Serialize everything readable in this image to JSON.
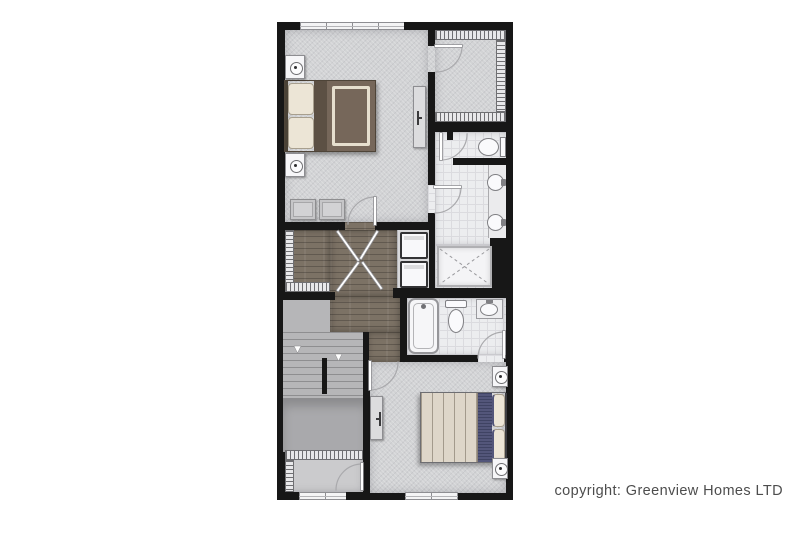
{
  "footer": {
    "copyright": "copyright: Greenview Homes LTD"
  },
  "colors": {
    "background": "#ffffff",
    "wall": "#171717",
    "carpet": "#d2d3d5",
    "tile": "#ecedef",
    "tile_line": "#dbdbdf",
    "wood": "#7c7265",
    "stair": "#b6b6b8",
    "stair_line": "#8e8e90",
    "landing": "#a9a9ac",
    "niche": "#d8d8da",
    "hatch_bg": "#e8e8ea",
    "hatch_line": "#6f6f72",
    "fixture_fill": "#f6f6f8",
    "fixture_line": "#8d8d91",
    "pillow": "#ece5d6",
    "pillow_line": "#a89f8e",
    "bed1_duvet": "#76675a",
    "bed1_fold": "#5c5044",
    "bed1_trim": "#e6dfce",
    "bed2_duvet": "#ded6c9",
    "bed2_line": "#a39a8c",
    "navy": "#53567a",
    "navy_dark": "#3f4363",
    "headboard": "#3e3e42",
    "door_arc": "#a9a9ac",
    "text": "#4d4d4d"
  },
  "legend": {
    "fixtures": [
      "double-bed",
      "pillows",
      "nightstand",
      "table-lamp",
      "dresser",
      "ottoman-seats",
      "closet-shelving",
      "toilet",
      "round-sink",
      "vanity-counter",
      "walk-in-shower",
      "bathtub",
      "stacked-washer-dryer",
      "staircase-down",
      "door-swing",
      "window"
    ]
  }
}
